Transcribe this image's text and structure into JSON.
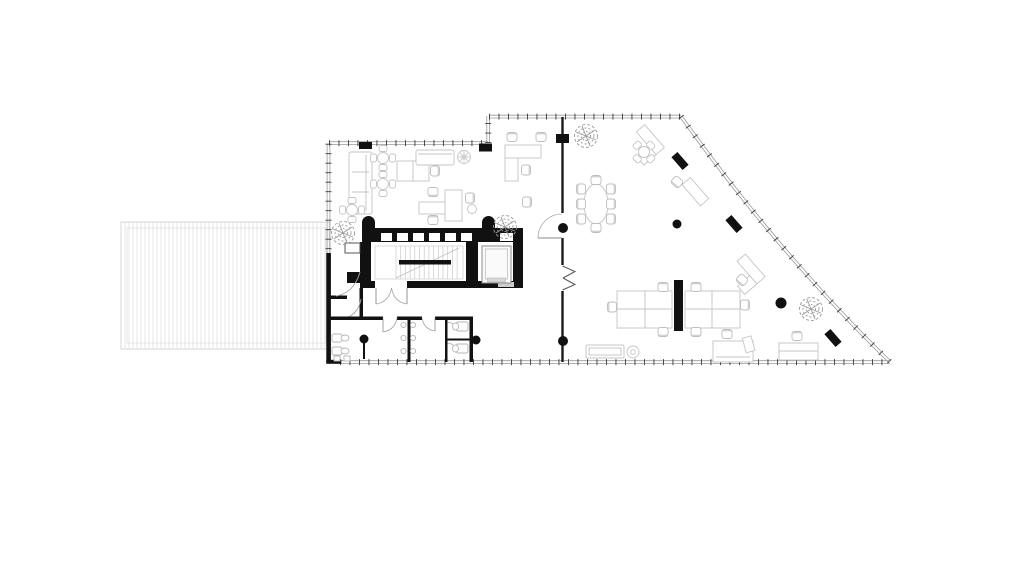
{
  "document": {
    "kind": "architectural floor plan",
    "content": "office floor plan with terrace deck, stair and elevator core, restrooms, and open office furniture"
  },
  "palette": {
    "background": "#ffffff",
    "wall_black": "#111111",
    "curtain_wall_line": "#9a9a9a",
    "curtain_wall_tick": "#3a3a3a",
    "furniture_line": "#c5c5c5",
    "fixture_line": "#b5b5b5",
    "plant_line": "#9a9a9a",
    "door_arc": "#a0a0a0",
    "terrace_hatch": "#e7e7e7",
    "terrace_border": "#d5d5d5"
  },
  "features": {
    "terrace": "hatched deck at west side",
    "core": "black stair core with elevator",
    "restrooms": "two restrooms with stalls and sinks at south-west",
    "partition": "full-height glazed partition with double entry doors",
    "columns": "six round structural columns and three angled facade columns",
    "plants": "four planters",
    "furniture": "workstations, meeting tables, sofas and reception desk"
  }
}
